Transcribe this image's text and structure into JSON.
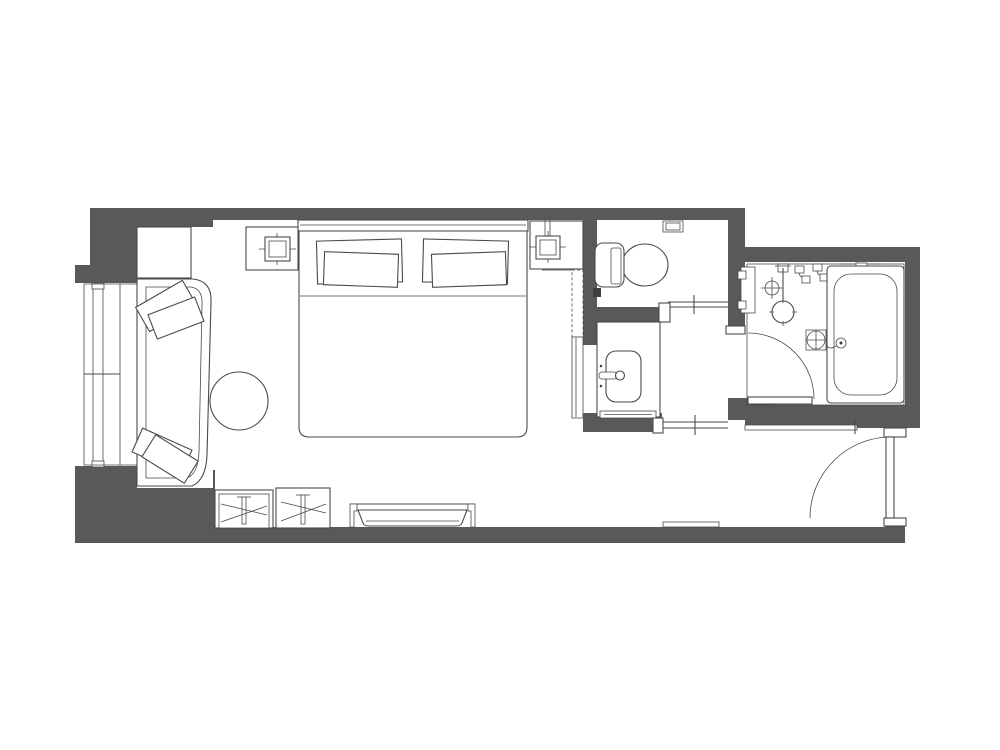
{
  "canvas": {
    "width": 1000,
    "height": 750
  },
  "palette": {
    "canvas_bg": "#ffffff",
    "wall_fill": "#58595b",
    "line_color": "#4a4a4c",
    "fixture_fill": "#3f3f41"
  },
  "plan": {
    "type": "hotel-guestroom-floor-plan",
    "text_labels": [],
    "rooms": [
      {
        "name": "bedroom"
      },
      {
        "name": "toilet-room"
      },
      {
        "name": "vanity-area"
      },
      {
        "name": "bathroom-with-tub"
      },
      {
        "name": "entry-hall"
      },
      {
        "name": "window-bay"
      }
    ],
    "furniture": [
      "king-bed",
      "headboard",
      "bed-pillows",
      "nightstand-left",
      "nightstand-right",
      "table-lamp-left",
      "table-lamp-right",
      "corner-table",
      "chaise-lounge",
      "chaise-cushions",
      "round-side-table",
      "luggage-rack-1",
      "luggage-rack-2",
      "luggage-bench",
      "wardrobe-unit"
    ],
    "fixtures": [
      "toilet",
      "flush-panel",
      "toilet-paper-holder",
      "vanity-counter",
      "sink-basin",
      "sink-faucet",
      "towel-bar",
      "bathtub",
      "tub-filler-set",
      "rain-shower-head",
      "shower-valve",
      "hand-shower-set",
      "wall-niche",
      "floor-drain",
      "ceiling-crosshair",
      "tub-overflow"
    ],
    "openings": [
      "window-glazing",
      "entry-swing-door",
      "bathroom-swing-door",
      "toilet-sliding-door",
      "hall-sliding-door"
    ]
  }
}
